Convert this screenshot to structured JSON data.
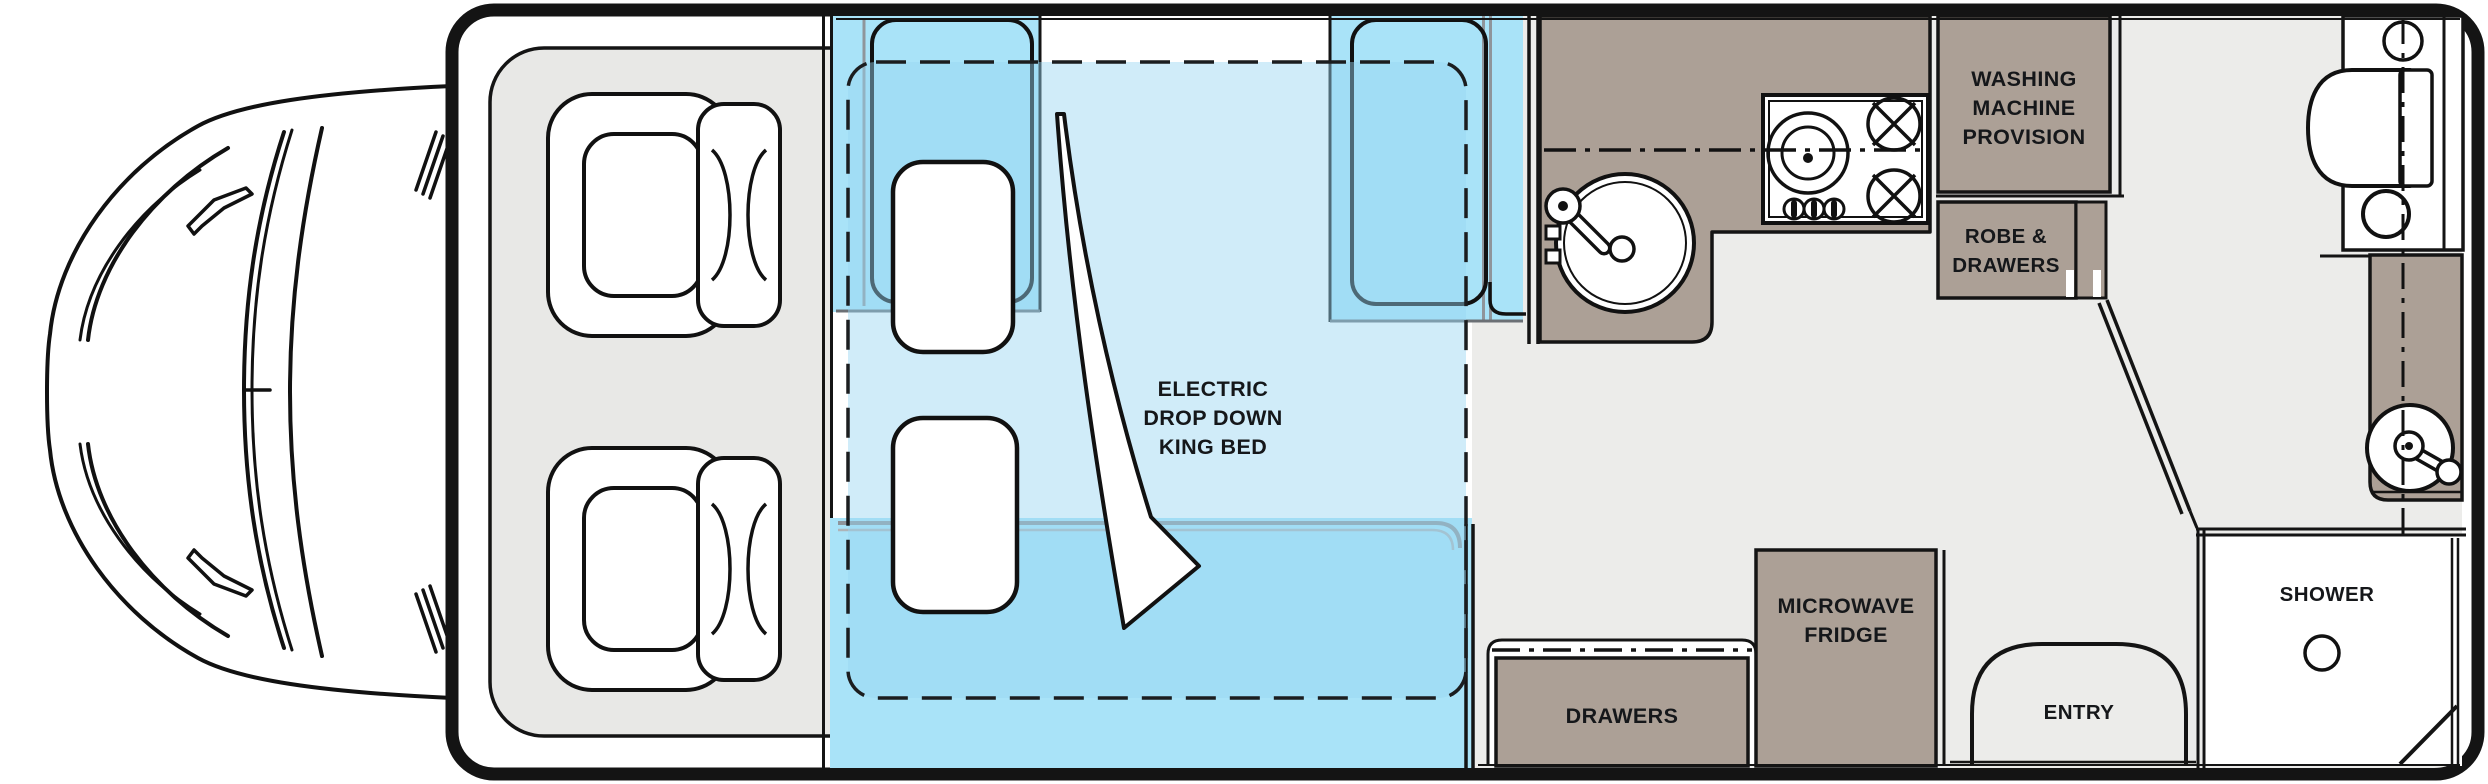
{
  "floorplan": {
    "type": "motorhome-floorplan-top-view",
    "bed_label": {
      "l1": "ELECTRIC",
      "l2": "DROP DOWN",
      "l3": "KING BED"
    },
    "washing_machine_label": {
      "l1": "WASHING",
      "l2": "MACHINE",
      "l3": "PROVISION"
    },
    "robe_label": {
      "l1": "ROBE &",
      "l2": "DRAWERS"
    },
    "drawers_label": "DRAWERS",
    "microwave_label": {
      "l1": "MICROWAVE",
      "l2": "FRIDGE"
    },
    "entry_label": "ENTRY",
    "shower_label": "SHOWER",
    "colors": {
      "wall_black": "#141414",
      "floor_gray": "#ECECEA",
      "cab_platform_gray": "#E8E8E6",
      "cabinet_taupe": "#ACA096",
      "sofa_cyan": "#A9E3F8",
      "bed_overlay_blue": "rgba(150,212,242,0.45)",
      "detail_gray": "#8F959B",
      "fixture_white": "#FFFFFF"
    }
  }
}
